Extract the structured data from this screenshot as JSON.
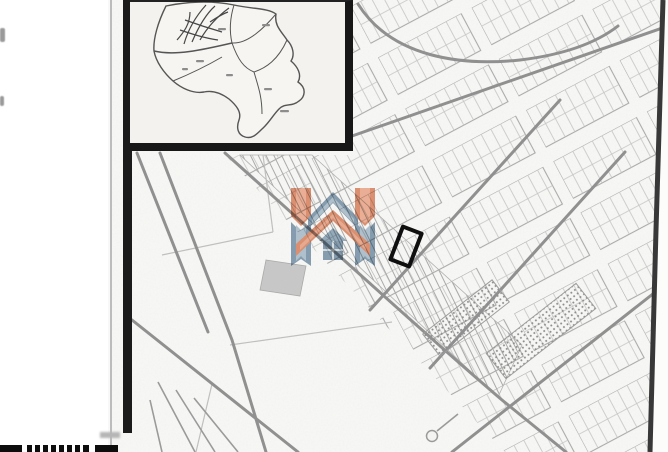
{
  "page": {
    "kind_label": "",
    "legible_text": "",
    "colors": {
      "page_bg": "#ffffff",
      "map_bg": "#f8f8f6",
      "parcel_line": "#c0c0c0",
      "block_line": "#a6a6a6",
      "road_line": "#8f8f8f",
      "frame_black": "#1b1b1b",
      "inset_bg": "#f3f2ef",
      "boundary_line": "#4f4f4f",
      "marker_black": "#0f0f0f",
      "logo_orange": "#e08a68",
      "logo_orange_light": "#f2ad92",
      "logo_blue": "#7e9ab0",
      "logo_blue_light": "#aec3d2",
      "scan_edge": "#383838"
    },
    "icons": [
      {
        "name": "house-h-logo-icon"
      },
      {
        "name": "plot-marker-rectangle"
      },
      {
        "name": "cul-de-sac-circle"
      }
    ],
    "inset_map": {
      "labels_legible": false,
      "district_count_visible": 7
    }
  }
}
